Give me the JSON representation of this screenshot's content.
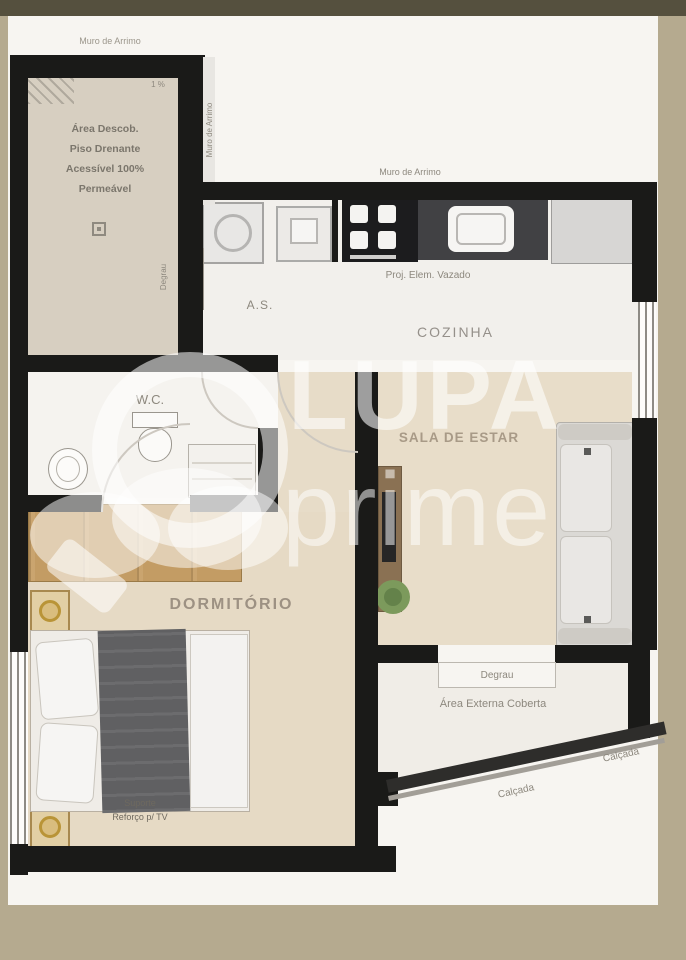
{
  "watermark": {
    "brand": "LUPA",
    "brand_sub": "prime"
  },
  "annotations": {
    "muro_top_left": "Muro de Arrimo",
    "muro_left_vertical": "Muro de Arrimo",
    "muro_top_center": "Muro de Arrimo",
    "slope": "1 %",
    "degrau_vertical": "Degrau",
    "calcada_upper": "Calçada",
    "calcada_lower": "Calçada"
  },
  "rooms": {
    "area_descoberta": {
      "line1": "Área Descob.",
      "line2": "Piso Drenante",
      "line3": "Acessível 100%",
      "line4": "Permeável"
    },
    "area_servico": {
      "label": "A.S."
    },
    "cozinha": {
      "label": "COZINHA",
      "note": "Proj. Elem. Vazado"
    },
    "wc": {
      "label": "W.C."
    },
    "sala_de_estar": {
      "label": "SALA DE ESTAR"
    },
    "dormitorio": {
      "label": "DORMITÓRIO",
      "tv_note_line1": "Suporte",
      "tv_note_line2": "Reforço p/ TV"
    },
    "area_externa": {
      "label": "Área Externa Coberta",
      "step_label": "Degrau"
    }
  },
  "colors": {
    "canvas": "#b5aa8f",
    "top_bar": "#55503e",
    "paper": "#f7f5f1",
    "wall": "#1a1a18",
    "floor_wood": "#e7dcc8",
    "floor_descoberta": "#d7cfc1",
    "wardrobe_wood": "#c79f66",
    "counter_dark": "#414144",
    "duvet_gray": "#606062",
    "plant_green": "#7c9a5c",
    "watermark_white": "rgba(255,255,255,0.55)"
  }
}
